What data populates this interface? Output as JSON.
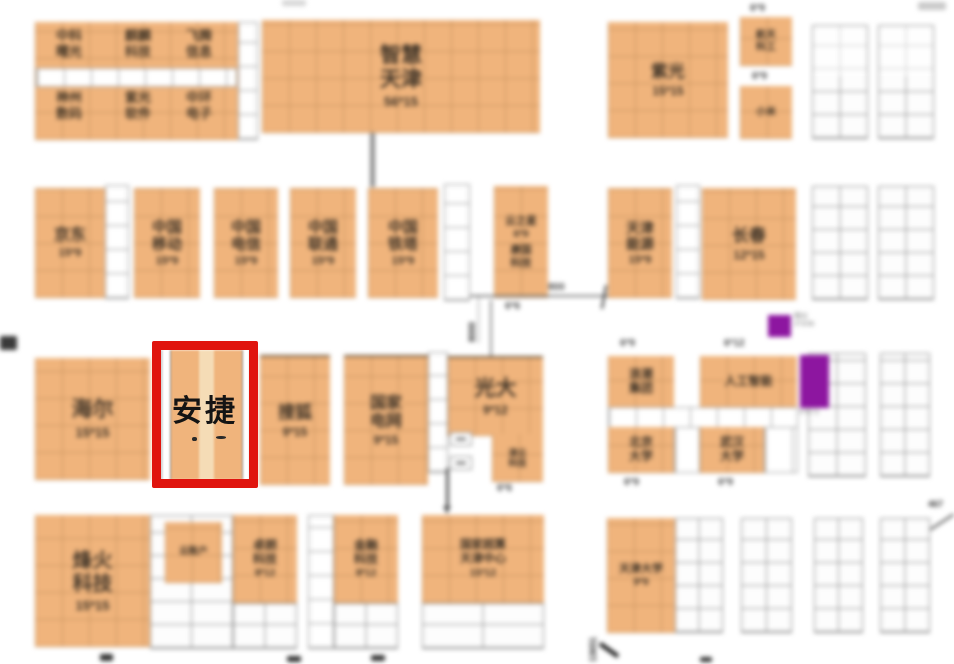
{
  "highlight": {
    "label": "安捷",
    "frame_color": "#e0150e"
  },
  "colors": {
    "booth_orange": "#f0b47c",
    "purple": "#8d16a0",
    "red": "#e0150e"
  },
  "booths": {
    "sugon": {
      "name": "中科\n曙光"
    },
    "qilin": {
      "name": "麒麟\n科技"
    },
    "feiteng": {
      "name": "飞腾\n信息"
    },
    "shuma": {
      "name": "神州\n数码"
    },
    "ziguang_soft": {
      "name": "紫光\n软件"
    },
    "zhonghuan": {
      "name": "中环\n电子"
    },
    "zhihui_tianjin": {
      "name": "智慧\n天津",
      "dim": "56*15"
    },
    "ziguang": {
      "name": "紫光",
      "dim": "15*15"
    },
    "tr1": {
      "dim_above": "6*9",
      "name": "航天\n科工"
    },
    "tr2": {
      "dim_above": "6*9",
      "name": "小米"
    },
    "jingdong": {
      "name": "京东",
      "dim": "15*9"
    },
    "yidong": {
      "name": "中国\n移动",
      "dim": "15*9"
    },
    "dianxin": {
      "name": "中国\n电信",
      "dim": "15*9"
    },
    "liantong": {
      "name": "中国\n联通",
      "dim": "15*9"
    },
    "tieta": {
      "name": "中国\n铁塔",
      "dim": "15*9"
    },
    "zhixing": {
      "name": "云之星",
      "dim": "6*9",
      "name2": "康国\n科技",
      "dim_below": "6*6"
    },
    "tj_nengyuan": {
      "name": "天津\n能源",
      "dim": "15*9"
    },
    "changchun": {
      "name": "长春",
      "dim": "12*15"
    },
    "haier": {
      "name": "海尔",
      "dim": "15*15"
    },
    "sohu": {
      "name": "搜狐",
      "dim": "9*15"
    },
    "guojia_dianwang": {
      "name": "国家\n电网",
      "dim": "9*15"
    },
    "guangda": {
      "name": "光大",
      "dim": "9*12"
    },
    "guangda_sub": {
      "name": "津云\n科技",
      "dim_below": "6*6"
    },
    "langchao": {
      "dim_above": "6*9",
      "name": "浪潮\n集团"
    },
    "rengong": {
      "dim_above": "6*12",
      "name": "人工智能"
    },
    "beida": {
      "name": "北京\n大学",
      "dim_below": "6*9"
    },
    "wuda": {
      "name": "武汉\n大学",
      "dim_below": "6*9"
    },
    "fenghuo": {
      "name": "烽火\n科技",
      "dim": "15*15"
    },
    "yunzhanghu": {
      "name": "云账户"
    },
    "zhuolang": {
      "name": "卓朗\n科技",
      "dim": "9*12"
    },
    "jinrong": {
      "name": "金融\n科技",
      "dim": "9*12"
    },
    "chaosuan": {
      "name": "国家超算\n天津中心",
      "dim": "15*12"
    },
    "tianda": {
      "name": "天津大学",
      "dim": "9*9"
    }
  },
  "purple_notes": {
    "small": "精仪\n3*3/36",
    "tall": "3*6/72"
  },
  "annotations": {
    "d800": "800",
    "d8000": "8000",
    "n467": "467",
    "n13651": "13651"
  }
}
